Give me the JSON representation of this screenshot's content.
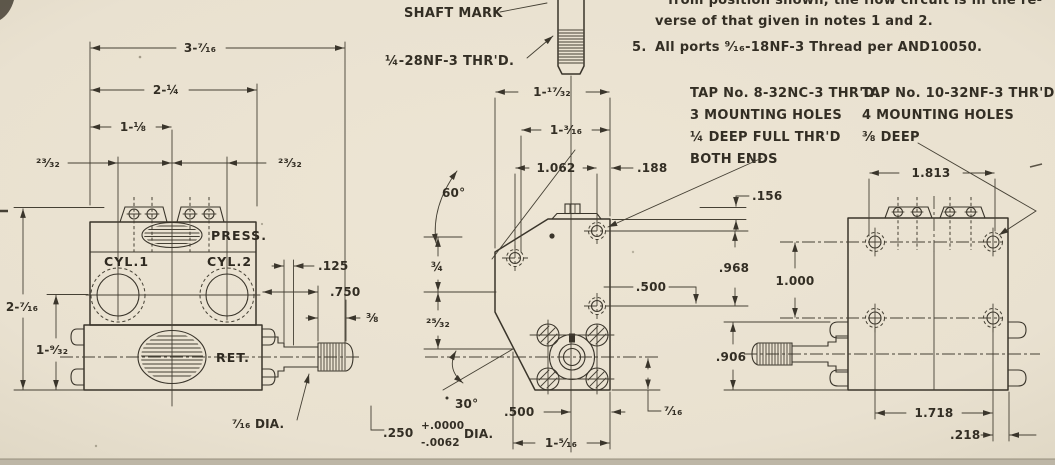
{
  "colors": {
    "paper": "#eae2d1",
    "ink": "#3a352b"
  },
  "notes": {
    "clipped_line": "from position shown, the flow circuit is in the re-",
    "line2": "verse of that given in notes 1 and 2.",
    "item5_no": "5.",
    "item5": "All ports ⁹⁄₁₆-18NF-3 Thread per AND10050."
  },
  "callouts": {
    "shaft_mark": "SHAFT MARK",
    "shaft_thread": "¼-28NF-3 THR'D.",
    "tap_left": {
      "l1": "TAP No. 8-32NC-3 THR'D.",
      "l2": "3 MOUNTING HOLES",
      "l3": "¼ DEEP FULL THR'D",
      "l4": "BOTH ENDS"
    },
    "tap_right": {
      "l1": "TAP No. 10-32NF-3 THR'D.",
      "l2": "4 MOUNTING HOLES",
      "l3": "⅜ DEEP"
    }
  },
  "front_view": {
    "ports": {
      "press": "PRESS.",
      "cyl1": "CYL.1",
      "cyl2": "CYL.2",
      "ret": "RET."
    },
    "dims": {
      "w_overall": "3-⁷⁄₁₆",
      "w_body": "2-¼",
      "w_half": "1-⅛",
      "off_l": "²³⁄₃₂",
      "off_r": "²³⁄₃₂",
      "h_overall": "2-⁷⁄₁₆",
      "h_lower": "1-⁹⁄₃₂",
      "step": ".125",
      "shaft_len": ".750",
      "thread_len": "⅜",
      "shaft_dia": "⁷⁄₁₆ DIA."
    }
  },
  "side_view": {
    "dims": {
      "w_overall": "1-¹⁷⁄₃₂",
      "w_upper": "1-³⁄₁₆",
      "hole_span": "1.062",
      "edge_off": ".188",
      "angle_top": "60°",
      "arc_upper": "¾",
      "arc_lower": "²⁵⁄₃₂",
      "angle_bottom": "30°",
      "tab_h": ".156",
      "hole_drop": ".968",
      "off_right": ".500",
      "off_bottom": ".500",
      "center_drop": "⁷⁄₁₆",
      "w_lower": "1-⁵⁄₁₆",
      "bore": ".250",
      "tol_plus": "+.0000",
      "tol_minus": "-.0062",
      "bore_suffix": "DIA."
    }
  },
  "rear_view": {
    "dims": {
      "span_top": "1.813",
      "hole_drop": "1.000",
      "shaft_drop": ".906",
      "span_bottom": "1.718",
      "edge_off": ".218"
    }
  }
}
